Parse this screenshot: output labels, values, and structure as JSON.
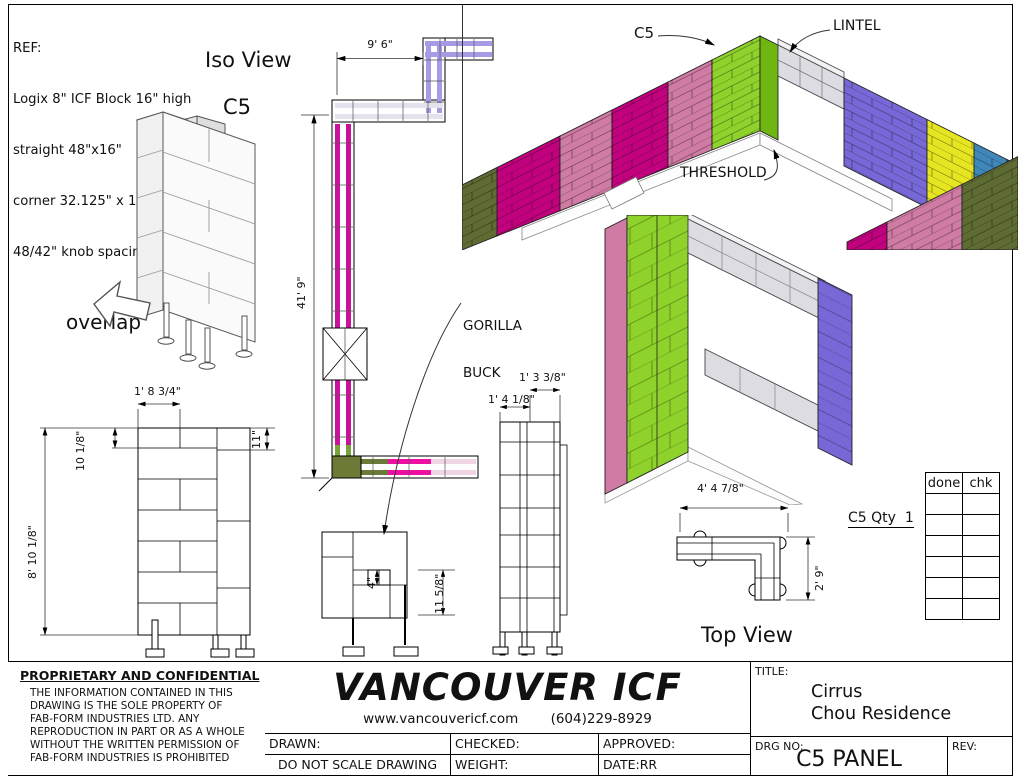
{
  "page": {
    "width": 1018,
    "height": 779
  },
  "ref_block": {
    "lines": [
      "REF:",
      "Logix 8\" ICF Block 16\" high",
      "straight 48\"x16\"",
      "corner 32.125\" x 16.125\"",
      "48/42\" knob spacing"
    ]
  },
  "labels": {
    "iso_view": "Iso View",
    "c5": "C5",
    "overlap": "overlap",
    "lintel": "LINTEL",
    "threshold": "THRESHOLD",
    "gorilla_buck": [
      "GORILLA",
      "BUCK"
    ],
    "top_view": "Top View",
    "c5_qty": "C5 Qty  1"
  },
  "dimensions": {
    "plan_width": "9' 6\"",
    "plan_height": "41' 9\"",
    "elev_width": "1' 8 3/4\"",
    "elev_top_course": "10 1/8\"",
    "elev_height": "8' 10 1/8\"",
    "elev_right_course": "11\"",
    "buck_gap": "4\"",
    "buck_height": "11 5/8\"",
    "side_top_width": "1' 3 3/8\"",
    "side_bottom_width": "1' 4 1/8\"",
    "top_view_width": "4' 4 7/8\"",
    "top_view_depth": "2' 9\""
  },
  "check_table": {
    "headers": [
      "done",
      "chk"
    ],
    "empty_rows": 6
  },
  "title_block": {
    "proprietary_heading": "PROPRIETARY AND CONFIDENTIAL",
    "proprietary_lines": [
      "THE INFORMATION CONTAINED IN THIS",
      "DRAWING IS THE SOLE PROPERTY OF",
      "FAB-FORM INDUSTRIES LTD. ANY",
      "REPRODUCTION IN PART OR AS A WHOLE",
      "WITHOUT THE WRITTEN PERMISSION OF",
      "FAB-FORM INDUSTRIES IS PROHIBITED"
    ],
    "company": "VANCOUVER ICF",
    "website": "www.vancouvericf.com",
    "phone": "(604)229-8929",
    "drawn_label": "DRAWN:",
    "checked_label": "CHECKED:",
    "approved_label": "APPROVED:",
    "no_scale": "DO NOT SCALE DRAWING",
    "weight_label": "WEIGHT:",
    "date_label": "DATE:RR",
    "title_label": "TITLE:",
    "title_line1": "Cirrus",
    "title_line2": "Chou Residence",
    "drg_no_label": "DRG NO:",
    "drg_no": "C5 PANEL",
    "rev_label": "REV:"
  },
  "palette": {
    "magenta": "#c2017e",
    "pink": "#cf7ba3",
    "green": "#8ed22b",
    "green_side": "#6fb612",
    "purple": "#7668d6",
    "yellow": "#e5e521",
    "teal": "#3e87b8",
    "olive": "#5e6b33",
    "lintel_gray": "#dcdce2",
    "buck_pink": "#ee0fa2"
  }
}
